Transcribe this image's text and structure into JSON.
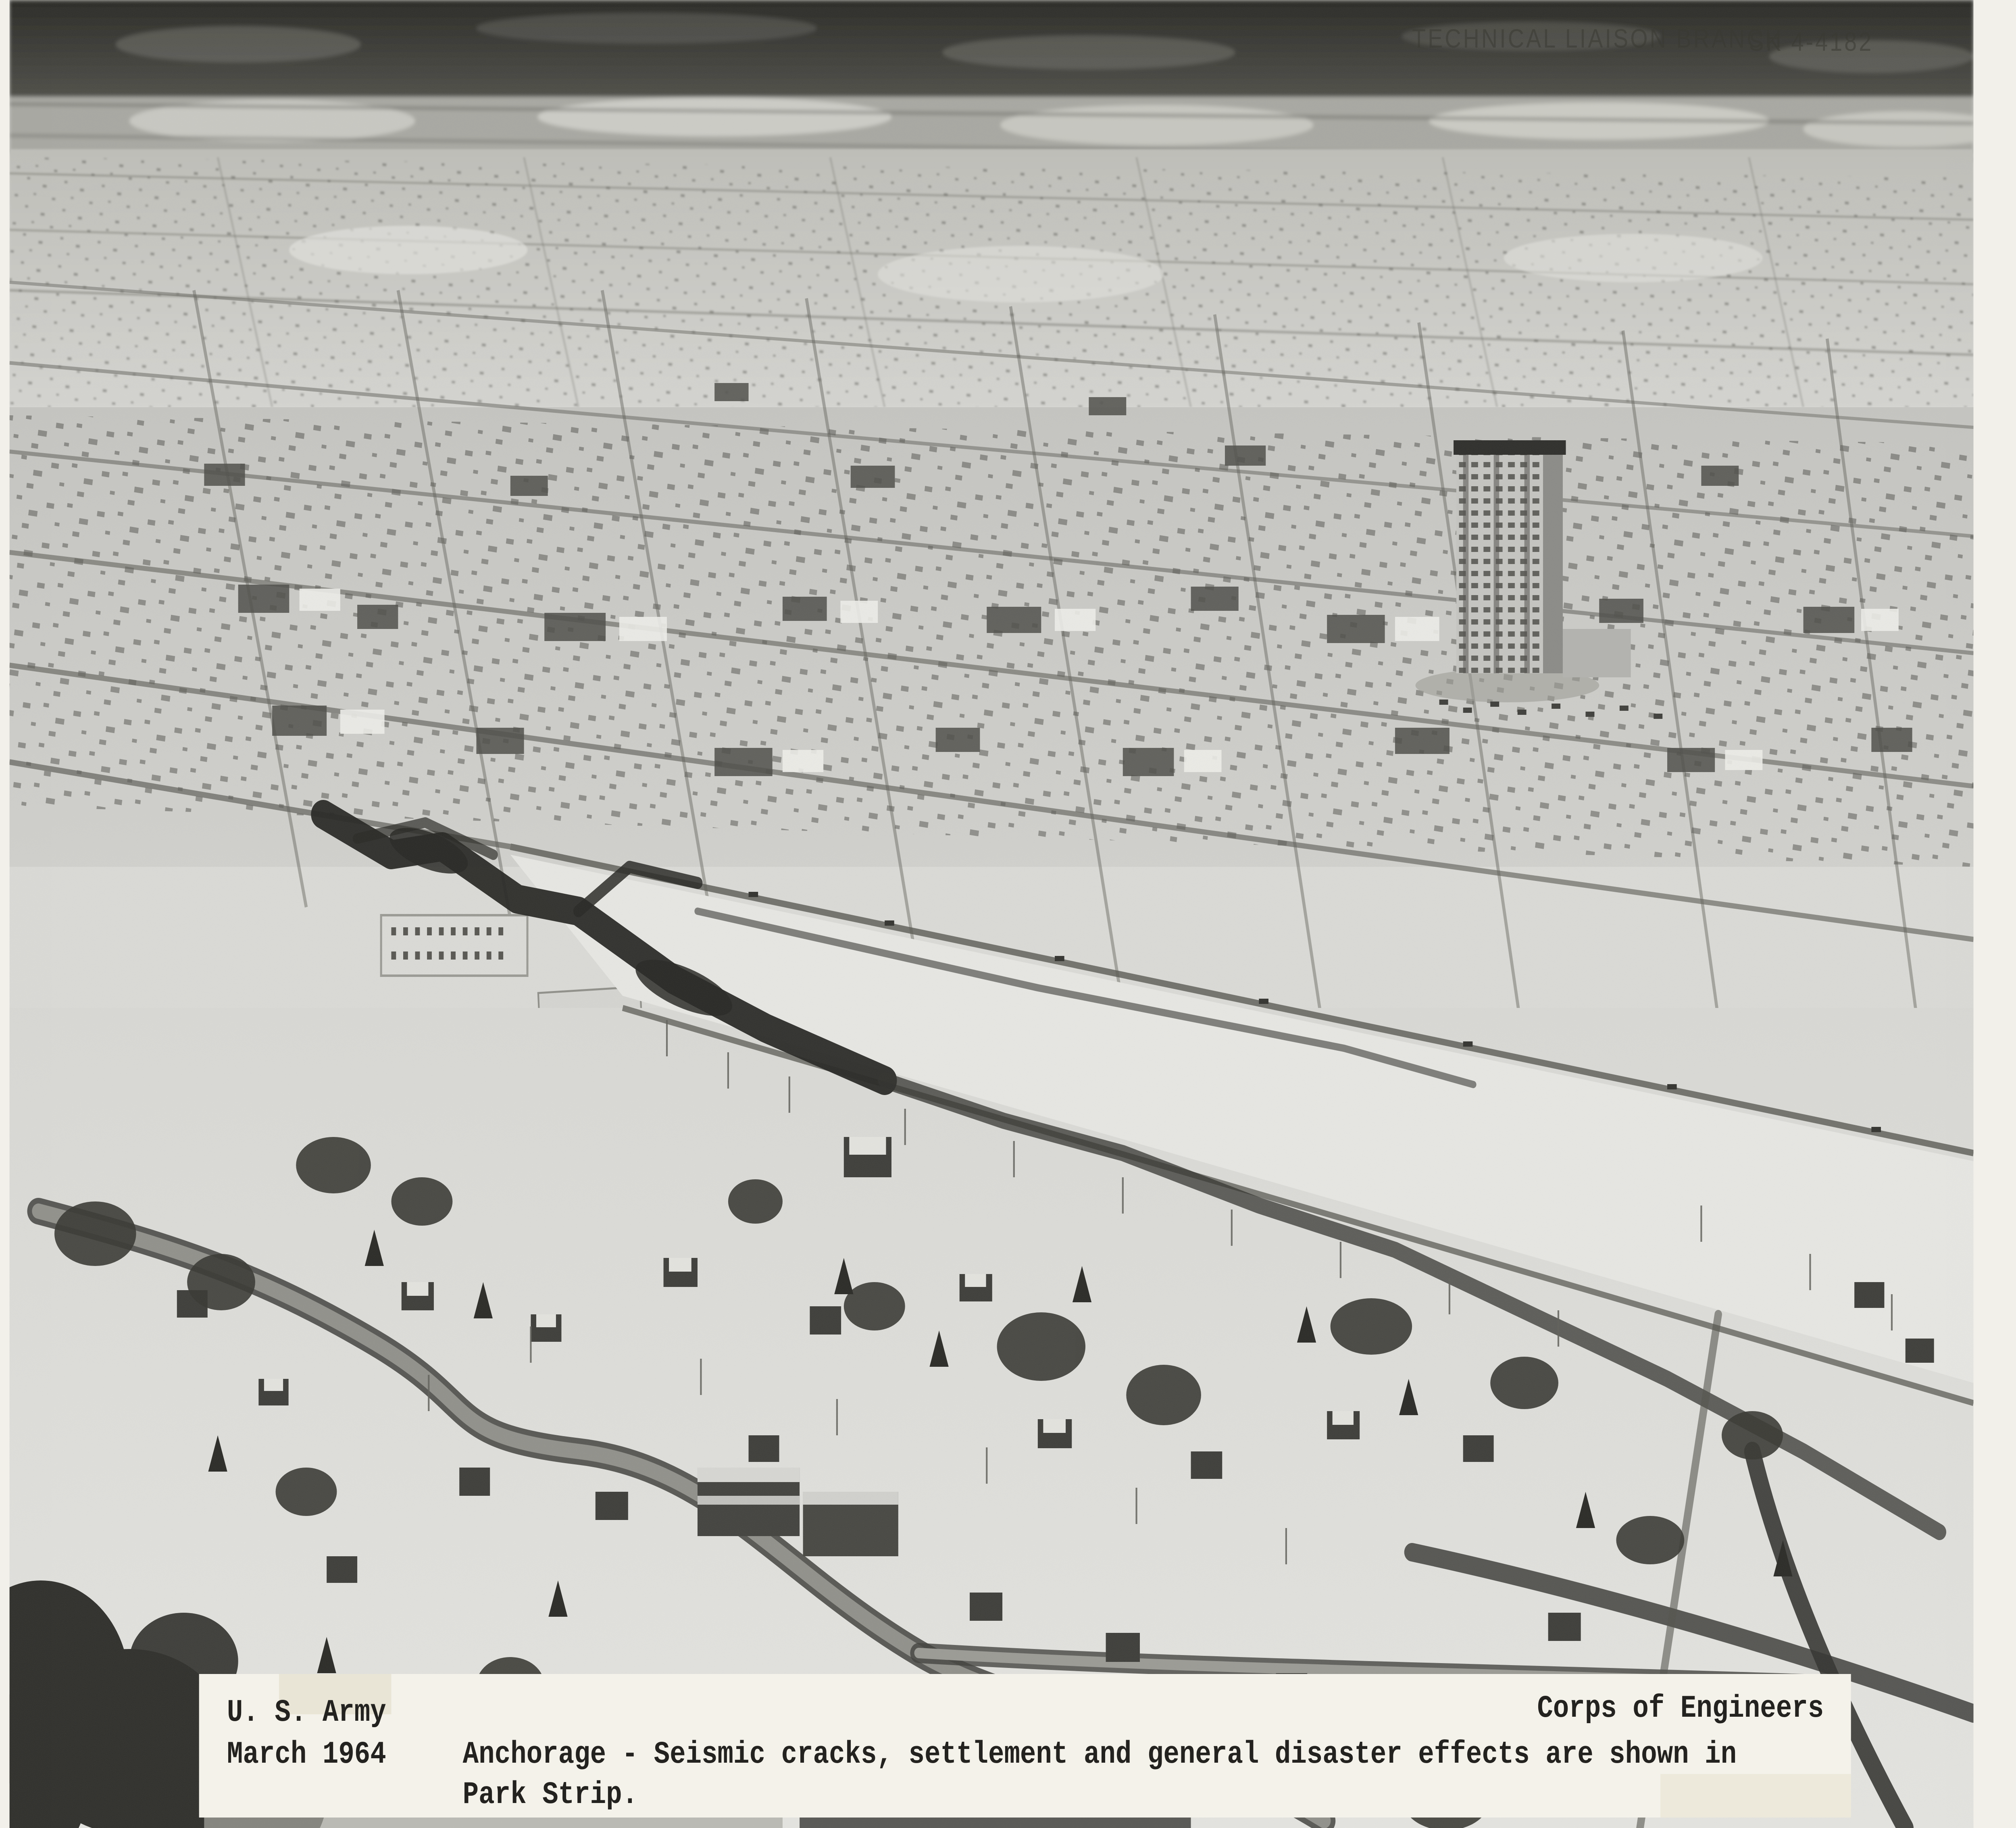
{
  "photo": {
    "stamp": {
      "agency_label": "TECHNICAL LIAISON BRANCH",
      "photo_number": "SK 4-4182"
    },
    "caption": {
      "left_line1": "U. S. Army",
      "left_line2": "March 1964",
      "right_credit": "Corps of Engineers",
      "body_line1": "Anchorage - Seismic cracks, settlement and general disaster effects are shown in",
      "body_line2": "Park Strip."
    }
  },
  "colors": {
    "scan_background": "#f2f0ea",
    "photo_base": "#dcdcd8",
    "forest_dark": "#30302c",
    "horizon_mid": "#a8a8a2",
    "distant_band": "#cfcfcb",
    "urban_band": "#c7c7c3",
    "snow_bottom": "#e2e2de",
    "park_strip_snow": "#e9e9e5",
    "street_ink": "#5d5d57",
    "crack_dark": "#232320",
    "road_gray": "#90908a",
    "tree_dark": "#2b2b27",
    "tower_face": "#c6c6c2",
    "tower_side": "#8a8a86",
    "caption_paper": "#f4f2ea",
    "caption_ink": "#23221f",
    "stamp_ink": "#3a3a33"
  }
}
